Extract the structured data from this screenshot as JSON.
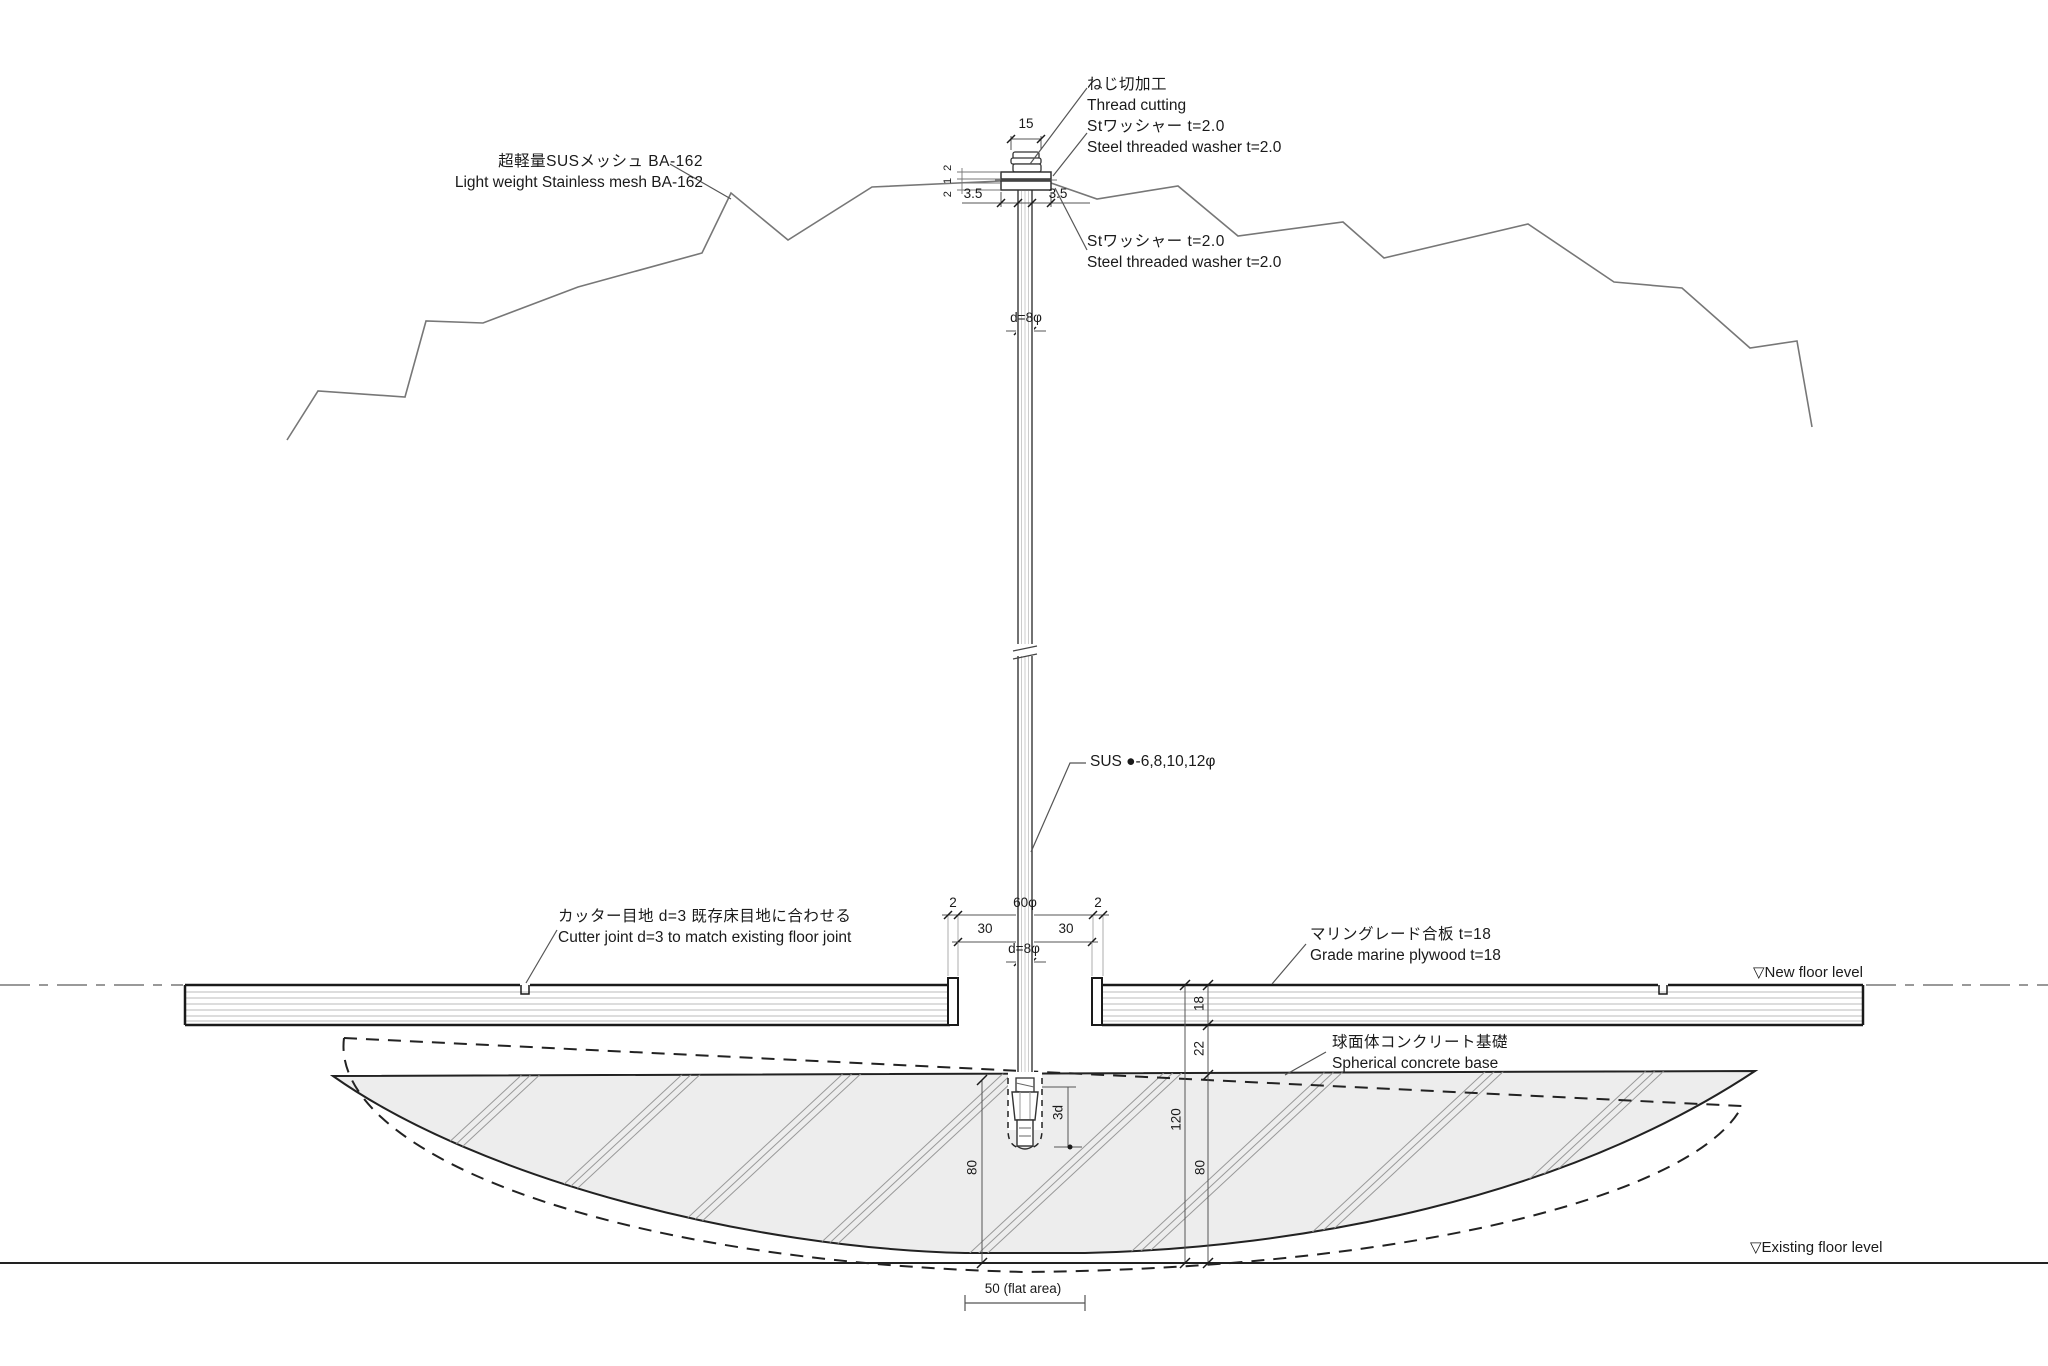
{
  "labels": {
    "thread_cutting": {
      "jp": "ねじ切加工",
      "en": "Thread cutting"
    },
    "washer_top": {
      "jp": "Stワッシャー t=2.0",
      "en": "Steel threaded washer t=2.0"
    },
    "washer_bottom": {
      "jp": "Stワッシャー t=2.0",
      "en": "Steel threaded washer t=2.0"
    },
    "mesh": {
      "jp": "超軽量SUSメッシュ BA-162",
      "en": "Light weight Stainless mesh BA-162"
    },
    "pole_spec": "SUS ●-6,8,10,12φ",
    "cutter_joint": {
      "jp": "カッター目地 d=3 既存床目地に合わせる",
      "en": "Cutter joint d=3 to match existing floor joint"
    },
    "plywood": {
      "jp": "マリングレード合板 t=18",
      "en": "Grade marine plywood t=18"
    },
    "concrete_base": {
      "jp": "球面体コンクリート基礎",
      "en": "Spherical concrete base"
    },
    "new_floor_level": "▽New floor level",
    "existing_floor_level": "▽Existing floor level"
  },
  "dimensions": {
    "cap_width": "15",
    "washer_stack": "2 1 2",
    "washer_offset_left": "3.5",
    "washer_offset_right": "3.5",
    "rod_dia_upper": "d=8φ",
    "joint_left": "2",
    "hole_dia": "60φ",
    "joint_right": "2",
    "half_span_left": "30",
    "half_span_right": "30",
    "rod_dia_floor": "d=8φ",
    "plywood_thickness": "18",
    "cavity_gap": "22",
    "overall_depth": "120",
    "base_depth_right": "80",
    "base_depth_left": "80",
    "anchor_embed": "3d",
    "flat_area": "50 (flat area)"
  },
  "colors": {
    "line": "#1a1a1a",
    "concrete_fill": "#ededed",
    "hatch": "#999999",
    "mesh_line": "#777777"
  }
}
